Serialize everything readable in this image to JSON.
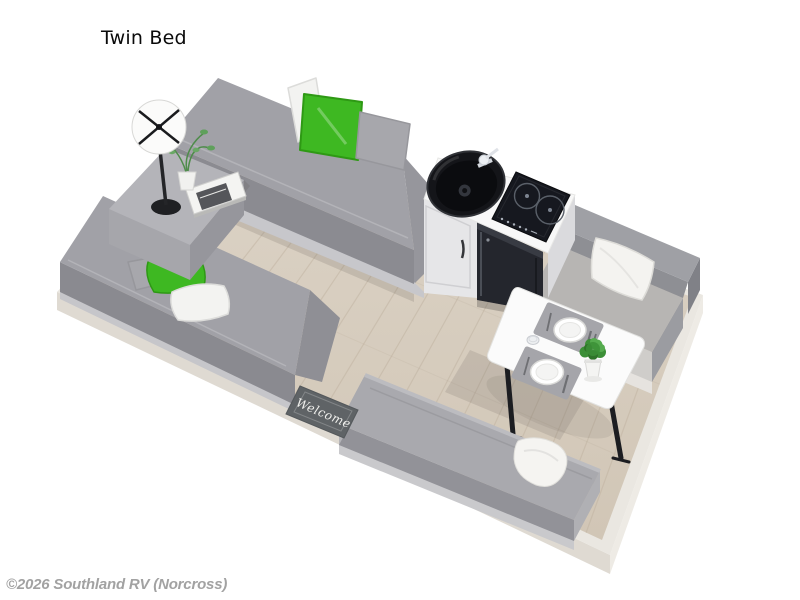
{
  "title": "Twin Bed",
  "watermark": "©2026 Southland RV (Norcross)",
  "scene": {
    "type": "3d-floorplan-render",
    "welcome_mat_text": "Welcome",
    "elements": [
      "wood-floor",
      "platform",
      "twin-bed-top",
      "twin-bed-bottom",
      "nightstand",
      "table-lamp",
      "nightstand-plant",
      "nightstand-books",
      "kitchen-cabinet",
      "kitchen-countertop",
      "kitchen-sink",
      "sink-faucet",
      "induction-cooktop",
      "refrigerator",
      "dinette-bench",
      "dinette-pillow-white",
      "dining-table",
      "place-settings",
      "table-plant",
      "drinking-glass",
      "bed-pillows-green",
      "bed-pillows-white",
      "bed-pillows-gray",
      "sofa-bench",
      "sofa-blanket",
      "welcome-mat"
    ],
    "colors": {
      "background": "#ffffff",
      "accent_green": "#3eb822",
      "upholstery_gray": "#a1a1a7",
      "cabinet_white": "#f8f8f8",
      "appliance_black": "#16181f",
      "wood_floor": "#d7cdc0",
      "platform": "#eae7e1",
      "title_black": "#0a0a0a",
      "watermark_gray": "#a2a2a2"
    }
  }
}
